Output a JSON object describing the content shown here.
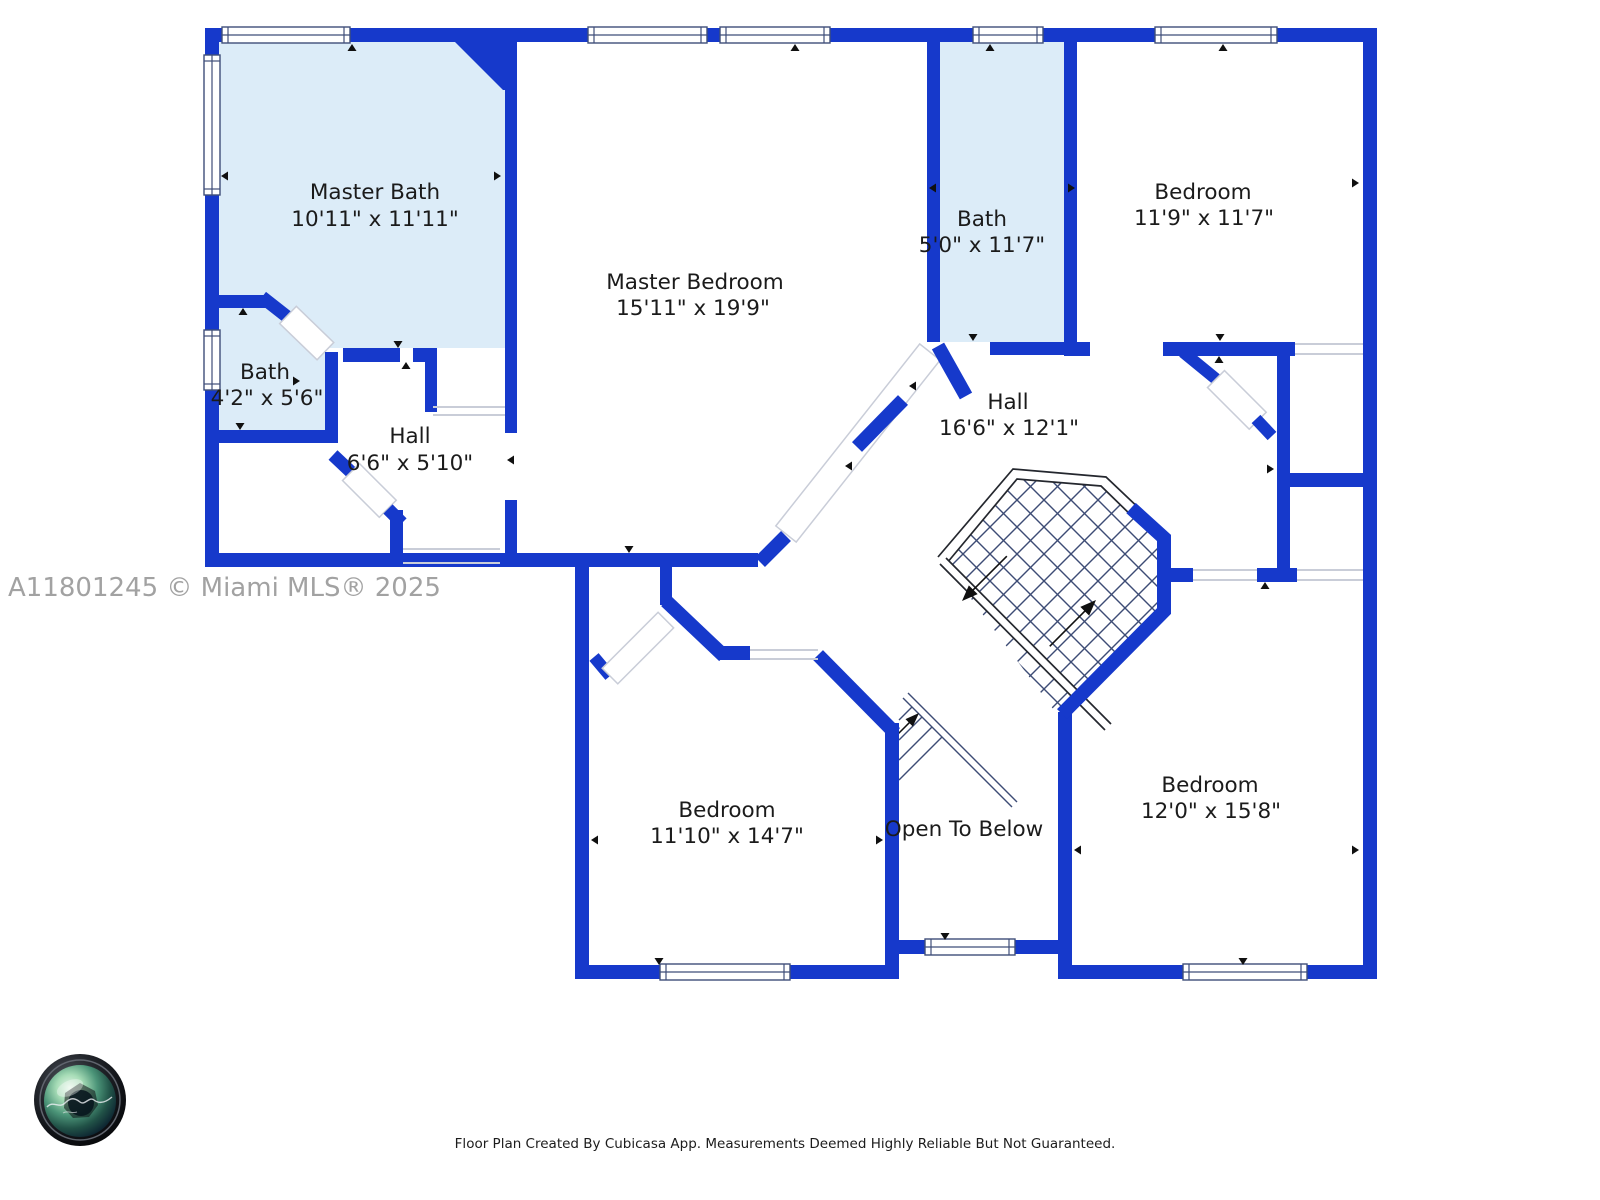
{
  "rooms": {
    "master_bath": {
      "name": "Master Bath",
      "dims": "10'11\" x 11'11\""
    },
    "bath_small": {
      "name": "Bath",
      "dims": "4'2\" x 5'6\""
    },
    "hall_small": {
      "name": "Hall",
      "dims": "6'6\" x 5'10\""
    },
    "master_bedroom": {
      "name": "Master Bedroom",
      "dims": "15'11\" x 19'9\""
    },
    "bath_upper": {
      "name": "Bath",
      "dims": "5'0\" x 11'7\""
    },
    "bedroom_top_right": {
      "name": "Bedroom",
      "dims": "11'9\" x 11'7\""
    },
    "hall_main": {
      "name": "Hall",
      "dims": "16'6\" x 12'1\""
    },
    "bedroom_bottom_left": {
      "name": "Bedroom",
      "dims": "11'10\" x 14'7\""
    },
    "open_to_below": {
      "name": "Open To Below"
    },
    "bedroom_bottom_right": {
      "name": "Bedroom",
      "dims": "12'0\" x 15'8\""
    }
  },
  "watermark": "A11801245 © Miami MLS® 2025",
  "footer": "Floor Plan Created By Cubicasa App. Measurements Deemed Highly Reliable But Not Guaranteed.",
  "colors": {
    "wall_blue": "#1639cb",
    "bath_fill": "#dcecf8",
    "room_fill": "#ffffff",
    "stair_line": "#3d4c75",
    "railing": "#24272e",
    "opening_gray": "#c9cdd8",
    "label_text": "#1b1b1b",
    "watermark_gray": "#a2a2a2"
  },
  "logo": {
    "kind": "photographer-camera-lens-logo"
  }
}
